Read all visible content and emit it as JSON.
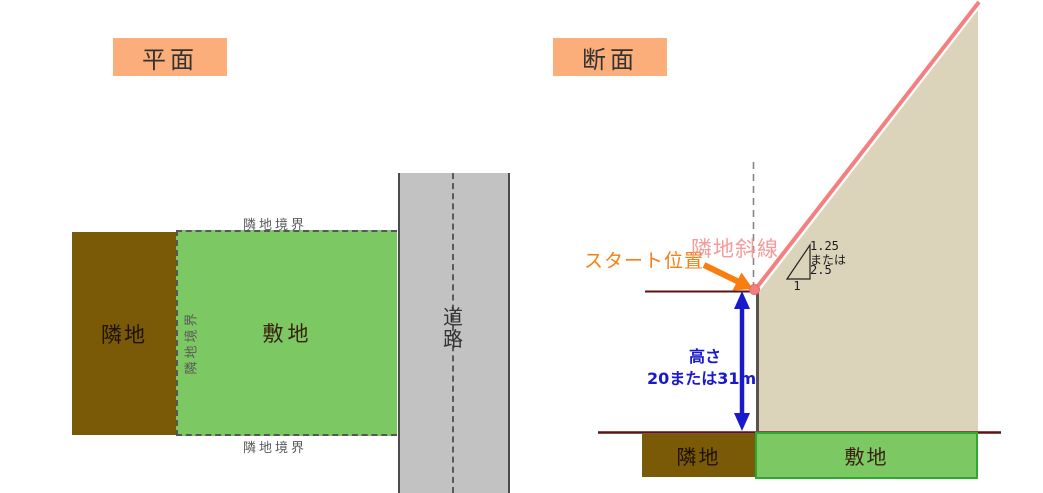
{
  "plan": {
    "title": "平面",
    "adjacent_land_label": "隣地",
    "site_label": "敷地",
    "boundary_top_label": "隣地境界",
    "boundary_bottom_label": "隣地境界",
    "boundary_left_label": "隣地境界",
    "road_label": "道路"
  },
  "section": {
    "title": "断面",
    "start_position_label": "スタート位置",
    "slant_line_label": "隣地斜線",
    "height_label": "高さ",
    "height_value": "20または31m",
    "slope_rise_option1": "1.25",
    "slope_or": "または",
    "slope_rise_option2": "2.5",
    "slope_run": "1",
    "adjacent_land_label": "隣地",
    "site_label": "敷地"
  },
  "colors": {
    "title_box_bg": "#FBAE7A",
    "adjacent_land_brown": "#7A5A07",
    "site_green": "#7CC862",
    "site_green_border": "#2FA82F",
    "road_gray": "#C2C2C2",
    "sky_area_beige": "#DCD3BB",
    "slant_line_pink": "#F57E7E",
    "slant_label_pink": "#F49B9B",
    "start_arrow_orange": "#F87E11",
    "height_arrow_blue": "#1A1ACC",
    "ground_line_maroon": "#5A1414",
    "boundary_dash_gray": "#565656"
  }
}
